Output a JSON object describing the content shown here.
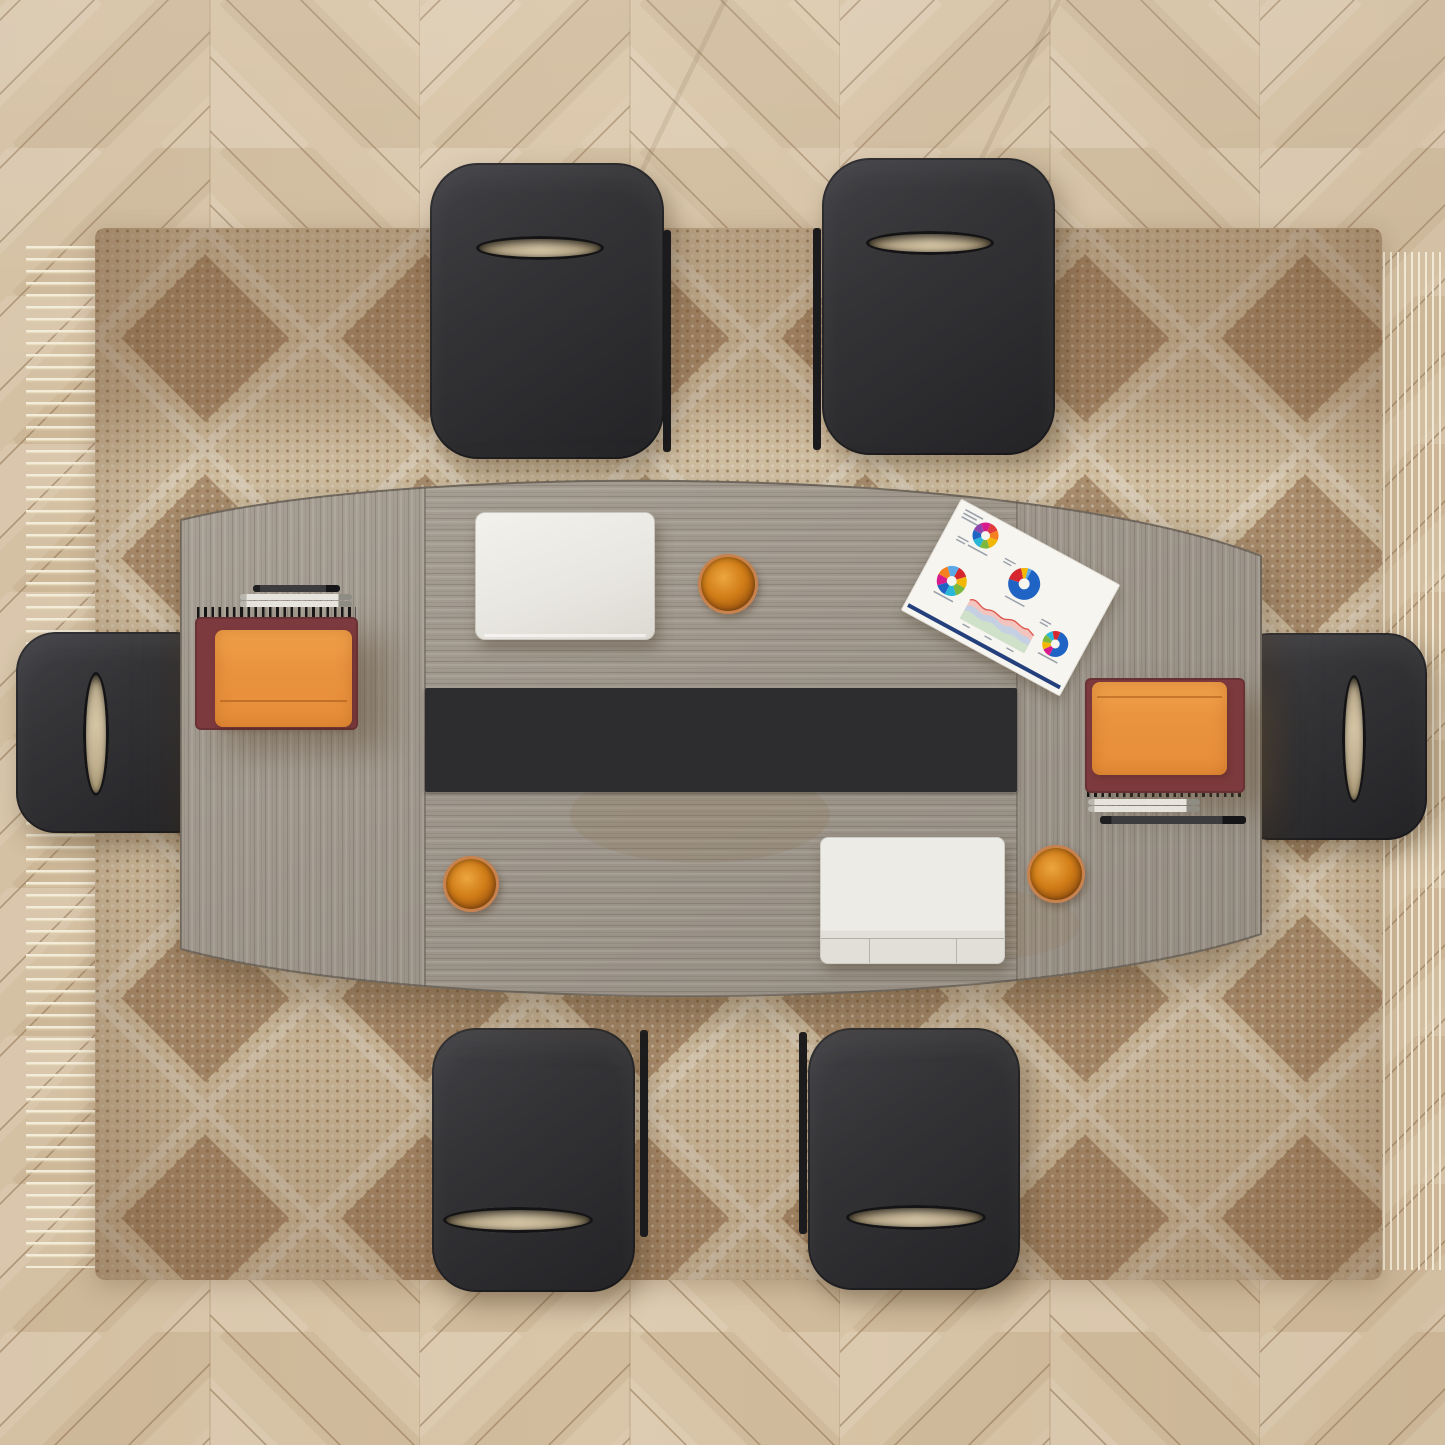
{
  "scene": {
    "type": "top-down product photograph",
    "subject": "boat-shaped conference table with six chairs on a bohemian rug over herringbone wood floor"
  },
  "floor": {
    "style": "herringbone wood planks",
    "base_color": "#d9c5a7",
    "gap_color": "#9a7f5f"
  },
  "rug": {
    "style": "diamond trellis weave with tassel fringe on left and right edges",
    "base_color": "#e8dabd",
    "diamond_color": "#7a4f2b",
    "trellis_line_color": "#f2ead6",
    "fringe_color": "#f3ecd8"
  },
  "table": {
    "shape": "boat-shaped, three sections",
    "wood_color": "#a09889",
    "seam_positions": "two vertical seams dividing end leaves from center leaf"
  },
  "runner": {
    "color": "#2d2d2f"
  },
  "chairs": {
    "count": 6,
    "color": "#2f2f32",
    "feature": "oval handle cutout in seat back showing rug beneath",
    "layout": [
      "top-left",
      "top-right",
      "bottom-left",
      "bottom-right",
      "left-end",
      "right-end"
    ]
  },
  "laptops": [
    {
      "state": "closed",
      "color": "#efede8",
      "position": "top-center of table"
    },
    {
      "state": "open with trackpad strip",
      "color": "#ebe9e4",
      "position": "bottom-center-right of table"
    }
  ],
  "notebooks": [
    {
      "position": "left end",
      "bottom_cover": "#7d3a3e",
      "top_notebook": "#ea9440",
      "binding": "black spiral on top edge",
      "pens": [
        "black pen",
        "two silver pens"
      ]
    },
    {
      "position": "right end",
      "bottom_cover": "#7d3a3e",
      "top_notebook": "#ea9440",
      "binding": "black spiral on bottom edge",
      "pens": [
        "two silver pens",
        "black pen"
      ]
    }
  ],
  "cups": [
    {
      "position": "top, right of closed laptop",
      "rim": "#c8824e",
      "drink": "#d07c17"
    },
    {
      "position": "bottom-left on table",
      "rim": "#c8824e",
      "drink": "#d07c17"
    },
    {
      "position": "bottom-right, right of open laptop",
      "rim": "#c8824e",
      "drink": "#d07c17"
    }
  ],
  "document": {
    "description": "white report sheet rotated on table, four donut charts, pastel area chart, navy footer bar",
    "charts": [
      {
        "id": "donut-a",
        "type": "donut",
        "cx": 38,
        "cy": 20,
        "r": 13,
        "hole": 4.5,
        "segments": [
          {
            "color": "#e23b3b",
            "value": 12.5
          },
          {
            "color": "#f4801f",
            "value": 12.5
          },
          {
            "color": "#f2b705",
            "value": 12.5
          },
          {
            "color": "#7cb83d",
            "value": 12.5
          },
          {
            "color": "#29b6d8",
            "value": 12.5
          },
          {
            "color": "#1f63c4",
            "value": 12.5
          },
          {
            "color": "#8e44ad",
            "value": 12.5
          },
          {
            "color": "#d81b8c",
            "value": 12.5
          }
        ]
      },
      {
        "id": "donut-b",
        "type": "donut",
        "cx": 95,
        "cy": 44,
        "r": 16,
        "hole": 5.5,
        "segments": [
          {
            "color": "#1f63c4",
            "value": 72
          },
          {
            "color": "#d6262e",
            "value": 17
          },
          {
            "color": "#f2b705",
            "value": 7
          },
          {
            "color": "#5aa9e6",
            "value": 4
          }
        ]
      },
      {
        "id": "donut-c",
        "type": "donut",
        "cx": 30,
        "cy": 76,
        "r": 15,
        "hole": 5,
        "segments": [
          {
            "color": "#d6262e",
            "value": 12.5
          },
          {
            "color": "#f2b705",
            "value": 12.5
          },
          {
            "color": "#7cb83d",
            "value": 12.5
          },
          {
            "color": "#29b6d8",
            "value": 12.5
          },
          {
            "color": "#1f63c4",
            "value": 12.5
          },
          {
            "color": "#d81b8c",
            "value": 12.5
          },
          {
            "color": "#f4801f",
            "value": 12.5
          },
          {
            "color": "#5aa9e6",
            "value": 12.5
          }
        ]
      },
      {
        "id": "donut-d",
        "type": "donut",
        "cx": 151,
        "cy": 82,
        "r": 13,
        "hole": 4.5,
        "segments": [
          {
            "color": "#1f63c4",
            "value": 50
          },
          {
            "color": "#d81b8c",
            "value": 11
          },
          {
            "color": "#f2b705",
            "value": 10
          },
          {
            "color": "#7cb83d",
            "value": 10
          },
          {
            "color": "#29b6d8",
            "value": 9
          },
          {
            "color": "#d6262e",
            "value": 10
          }
        ]
      },
      {
        "id": "area",
        "type": "area",
        "layers": [
          "#f3bcb6",
          "#bcd1e8",
          "#cfe2c5"
        ],
        "line": "#dd5a52"
      }
    ],
    "footer_bar_color": "#24407c"
  }
}
